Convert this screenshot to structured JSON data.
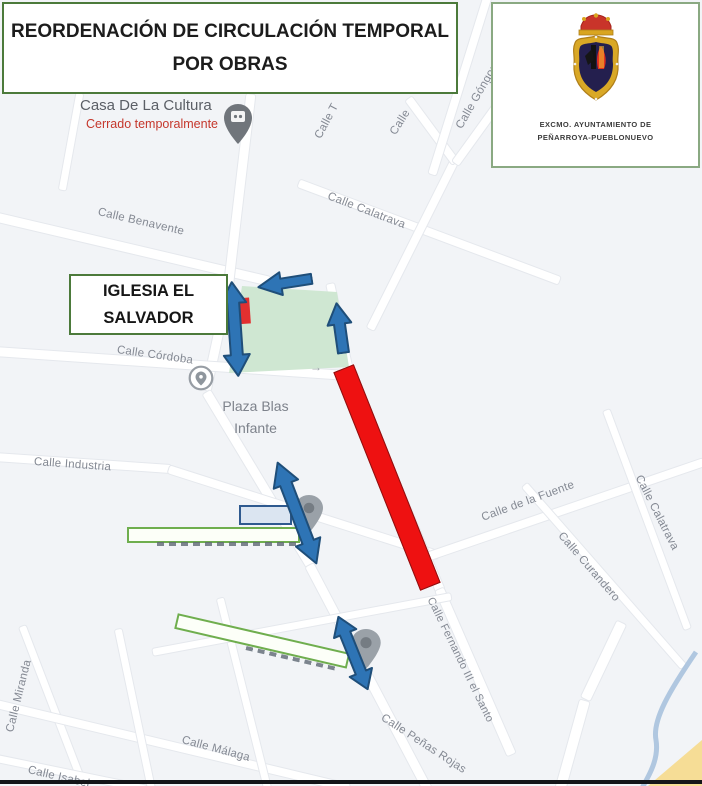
{
  "title": {
    "line1": "REORDENACIÓN DE CIRCULACIÓN TEMPORAL",
    "line2": "POR OBRAS"
  },
  "crest": {
    "org_line1": "EXCMO. AYUNTAMIENTO DE",
    "org_line2": "PEÑARROYA-PUEBLONUEVO"
  },
  "callouts": {
    "iglesia_line1": "IGLESIA EL",
    "iglesia_line2": "SALVADOR"
  },
  "map": {
    "pois": {
      "casa_name": "Casa De La Cultura",
      "casa_status": "Cerrado temporalmente",
      "plaza_line1": "Plaza Blas",
      "plaza_line2": "Infante"
    },
    "street_labels": {
      "benavente": "Calle Benavente",
      "calatrava_top": "Calle Calatrava",
      "calle_t": "Calle T",
      "calle_partial": "Calle",
      "gongora": "Calle Góngora",
      "cordoba": "Calle Córdoba",
      "industria": "Calle Industria",
      "fuente": "Calle de la Fuente",
      "curandero": "Calle Curandero",
      "calatrava_right": "Calle Calatrava",
      "fernando": "Calle Fernando III el Santo",
      "penas_rojas": "Calle Peñas Rojas",
      "miranda": "Calle Miranda",
      "malaga": "Calle Málaga",
      "isabel": "Calle Isabel"
    },
    "one_way_marker": "→"
  },
  "colors": {
    "map_bg": "#f2f4f7",
    "street_fill": "#ffffff",
    "label_gray": "#848993",
    "box_border_green": "#4c7a3b",
    "bar_outline_green": "#6fae4e",
    "zone_green": "#cfe7d2",
    "arrow_blue": "#2e74b5",
    "arrow_outline": "#1f4e79",
    "closed_red": "#ee1111",
    "blue_rect_fill": "#dbe5f1",
    "river_blue": "#a9c2dd",
    "road_yellow": "#f6dd96"
  }
}
